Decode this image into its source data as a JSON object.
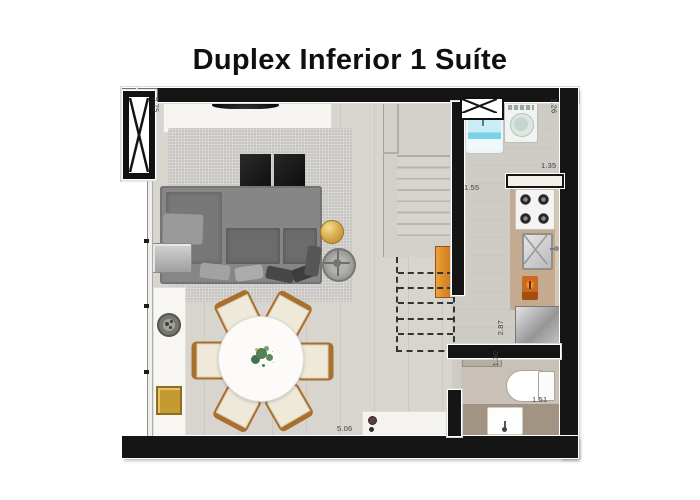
{
  "title": "Duplex Inferior 1 Suíte",
  "dimensions": {
    "living_height": "5.75",
    "service_width": "1.26",
    "hall_width": "1.55",
    "counter_length": "1.35",
    "kitchen_run": "2.87",
    "bath_width": "1.30",
    "bath_length": "1.51",
    "living_width": "5.06"
  },
  "objects": [
    "window",
    "vent-shaft",
    "laundry-sink",
    "washing-machine",
    "kitchen-pass-counter",
    "stove",
    "kitchen-sink",
    "fridge",
    "stairs",
    "sofa",
    "tv",
    "tv-console",
    "rug",
    "coffee-table-ottomans",
    "gold-side-table",
    "metal-side-table",
    "sideboard",
    "decor-plate",
    "decor-gold-box",
    "dining-table",
    "dining-chairs",
    "plant-centerpiece",
    "entry-console",
    "bathroom-door",
    "toilet",
    "bathroom-sink",
    "glass-facade"
  ],
  "colors": {
    "wall": "#151515",
    "floor_living": "#d8d4ce",
    "floor_service": "#cfcbc5",
    "floor_bath": "#c9c1b7",
    "bath_counter": "#a29482",
    "counter_tan": "#c4ab90",
    "stair_orange": "#d8811f",
    "accent_gold": "#d2a94c",
    "laundry_blue": "#7fd0e8",
    "label_text": "#414141"
  }
}
